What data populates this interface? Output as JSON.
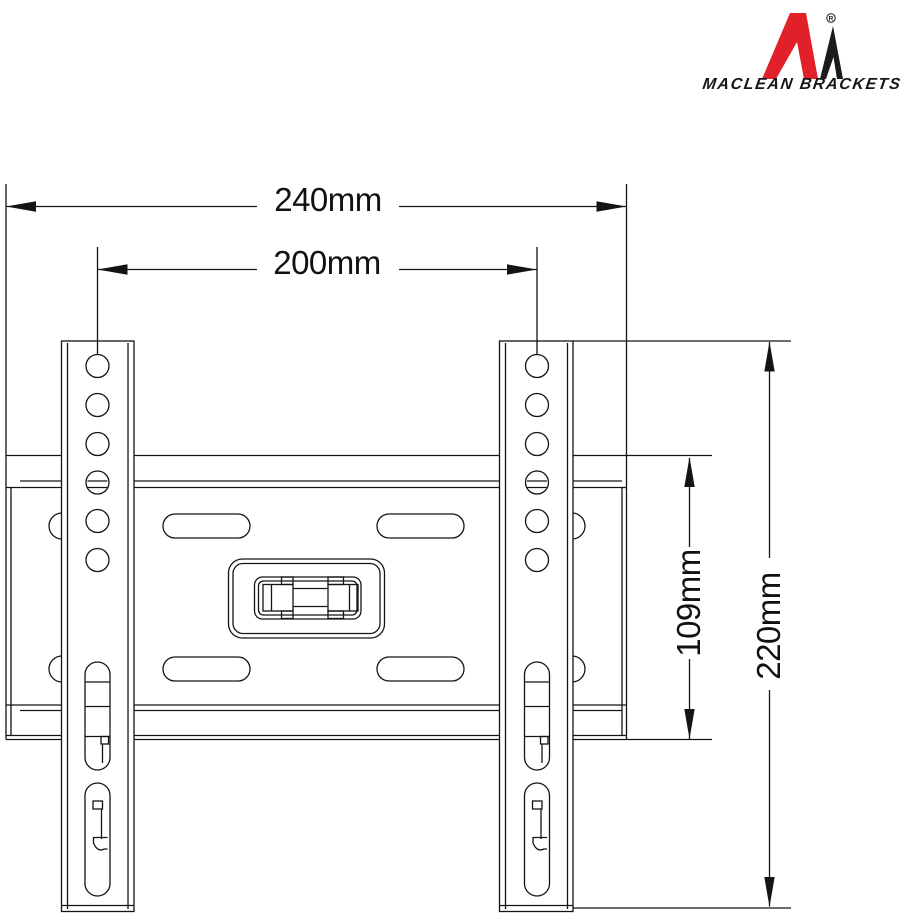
{
  "logo": {
    "brand": "MACLEAN BRACKETS",
    "registered": "R",
    "red": "#e2202a",
    "black": "#1b1b1b"
  },
  "dimensions": {
    "outer_width": "240mm",
    "hole_spacing_width": "200mm",
    "plate_height": "109mm",
    "rail_height": "220mm"
  },
  "drawing": {
    "line_color": "#141414",
    "background": "#ffffff"
  }
}
